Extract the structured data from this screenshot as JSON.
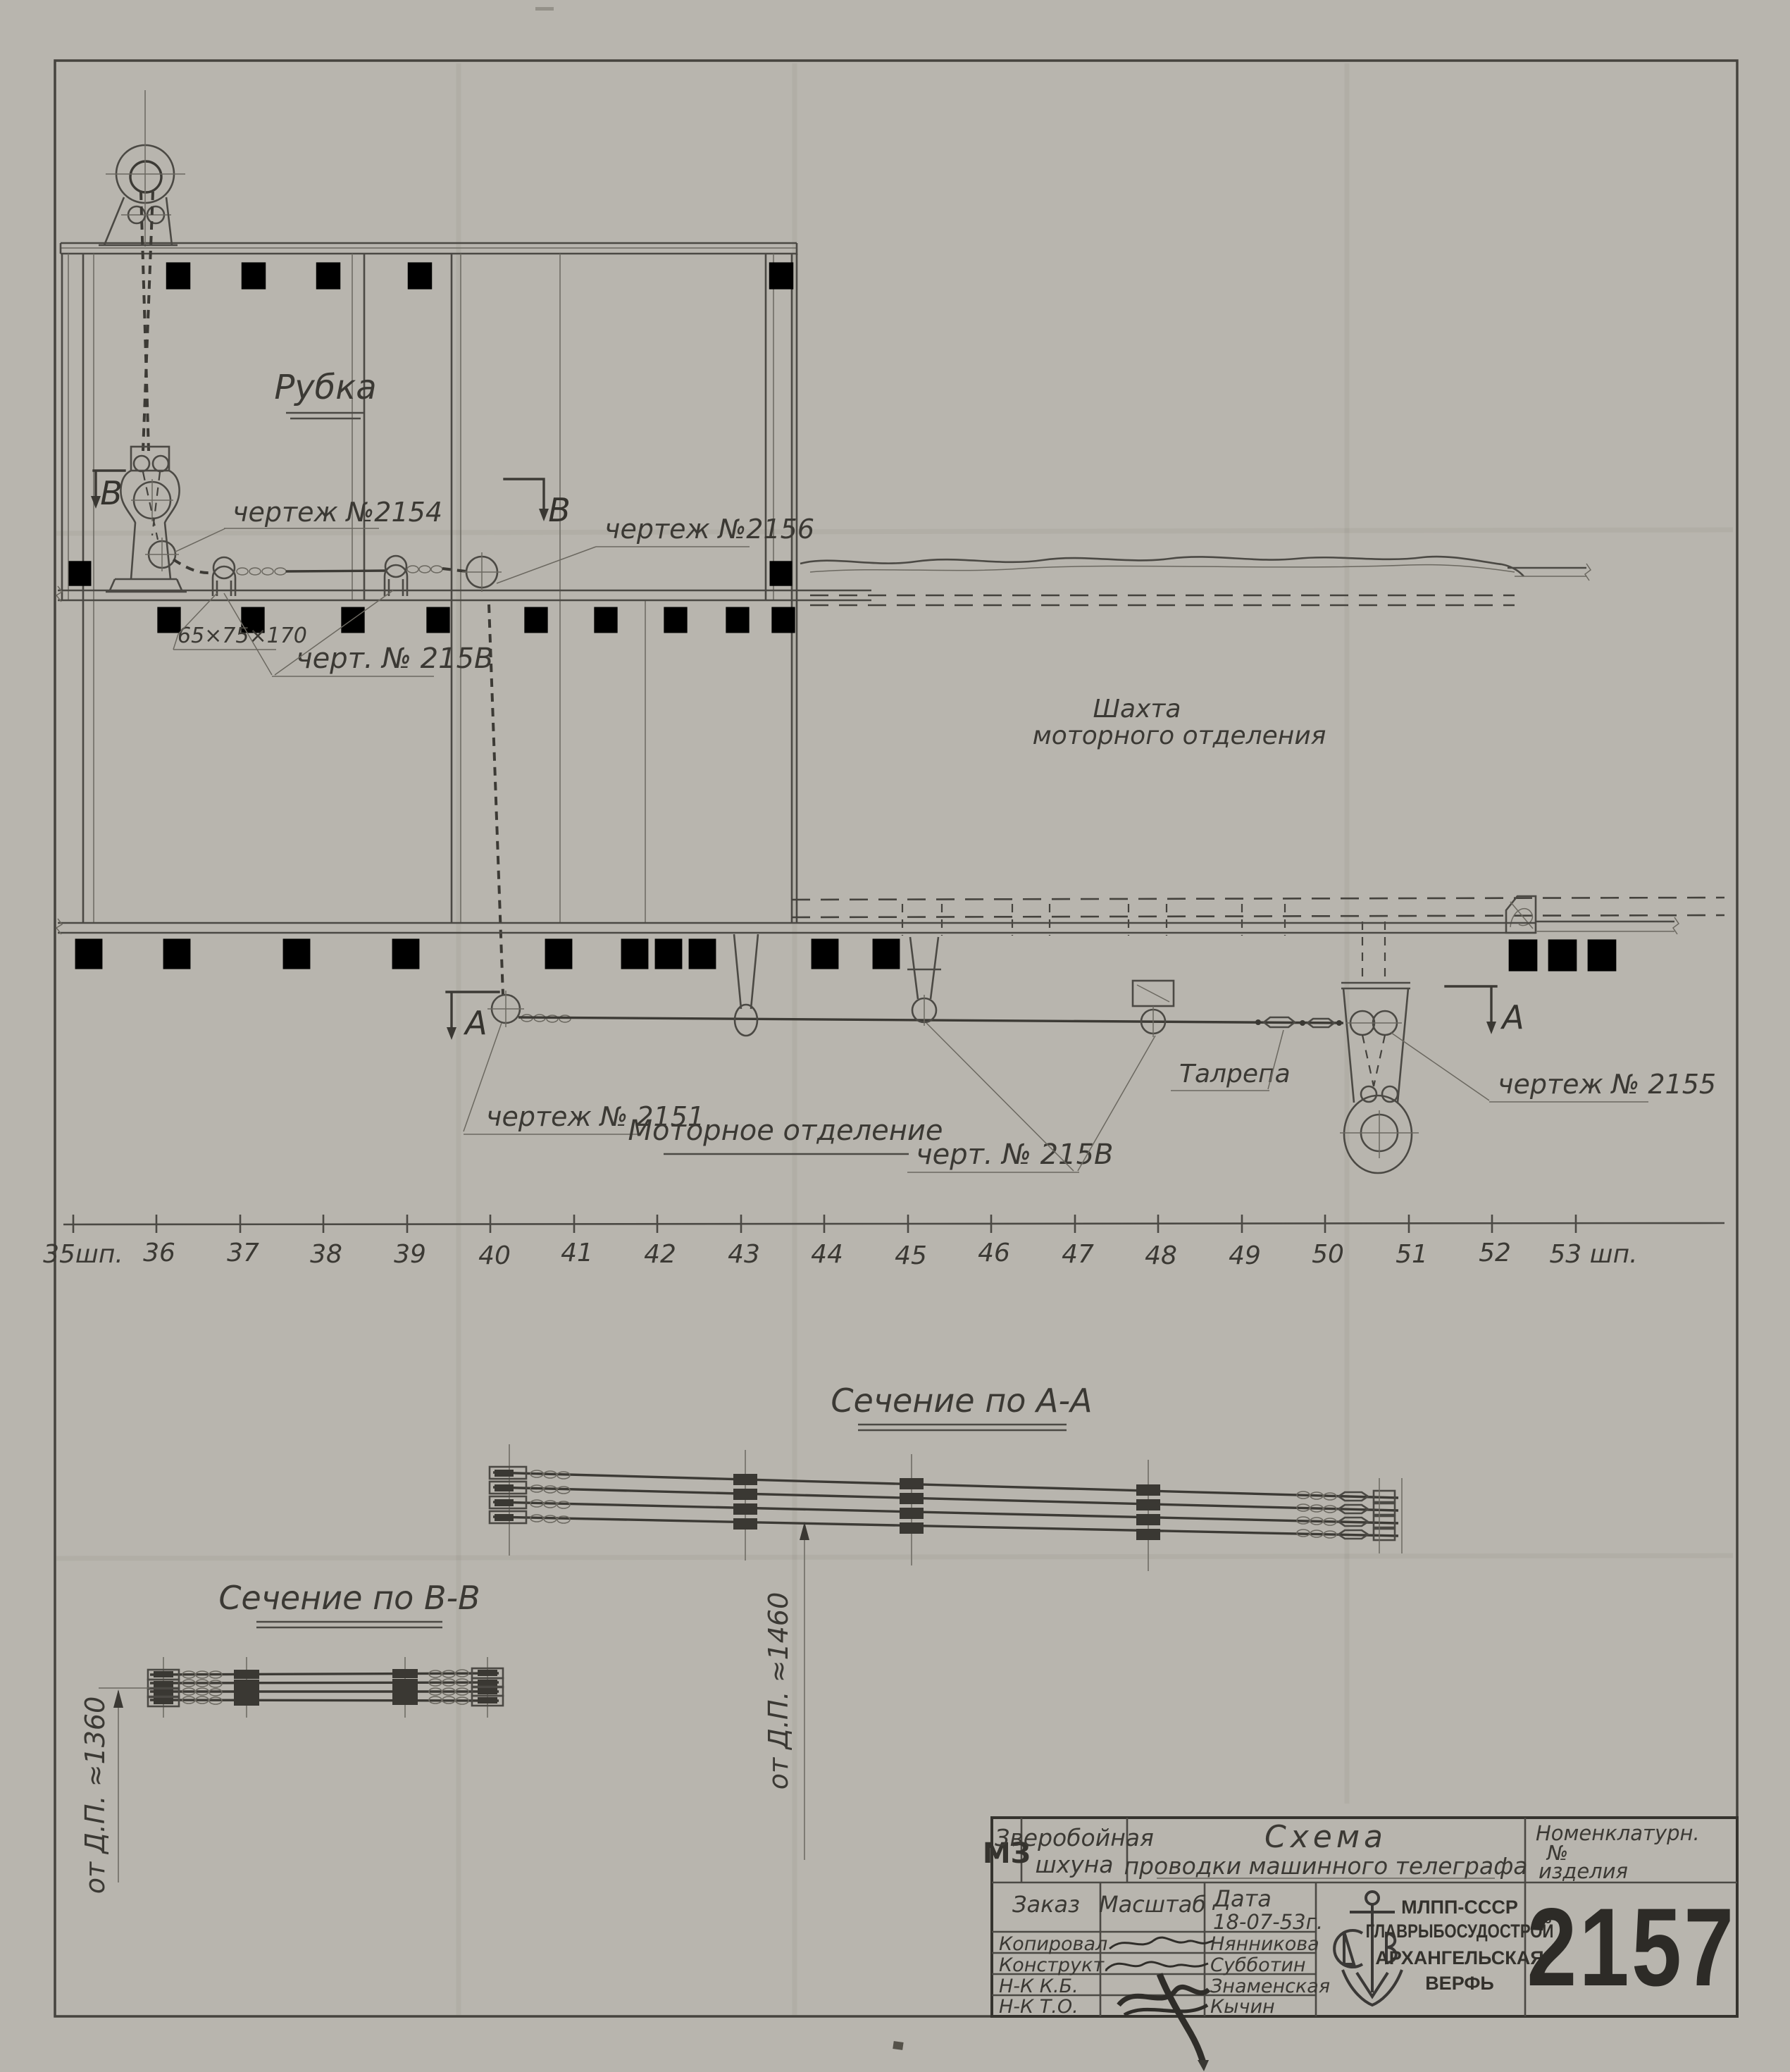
{
  "drawing": {
    "labels": {
      "rubka": "Рубка",
      "chertezh_2154": "чертеж №2154",
      "chertezh_2156": "чертеж №2156",
      "dim_65_75_170": "65×75×170",
      "chert_215v_upper": "черт. № 215В",
      "chertezh_2151": "чертеж № 2151",
      "chert_215v_lower": "черт. № 215В",
      "talrepa": "Талрепа",
      "chertezh_2155": "чертеж № 2155",
      "shahta_line1": "Шахта",
      "shahta_line2": "моторного отделения",
      "motornoe": "Моторное отделение",
      "section_b_mark_left": "В",
      "section_b_mark_right": "В",
      "section_a_mark_left": "А",
      "section_a_mark_right": "А",
      "section_aa_title": "Сечение по А-А",
      "section_bb_title": "Сечение по В-В",
      "dim_dp_1460": "от  Д.П. ≈1460",
      "dim_dp_1360": "от  Д.П. ≈1360"
    },
    "ruler": {
      "frames": [
        "35шп.",
        "36",
        "37",
        "38",
        "39",
        "40",
        "41",
        "42",
        "43",
        "44",
        "45",
        "46",
        "47",
        "48",
        "49",
        "50",
        "51",
        "52",
        "53 шп."
      ]
    },
    "title_block": {
      "code": "МЗ",
      "vessel_line1": "Зверобойная",
      "vessel_line2": "шхуна",
      "title_line1": "Схема",
      "title_line2": "проводки машинного телеграфа",
      "nomenclature_line1": "Номенклатурн.",
      "nomenclature_line2": "№",
      "nomenclature_line3": "изделия",
      "order_label": "Заказ",
      "scale_label": "Масштаб",
      "date_label": "Дата",
      "date_value": "18-07-53г.",
      "rows": [
        {
          "role": "Копировал",
          "name": "Нянникова"
        },
        {
          "role": "Конструкт.",
          "name": "Субботин"
        },
        {
          "role": "Н-К К.Б.",
          "name": "Знаменская"
        },
        {
          "role": "Н-К Т.О.",
          "name": "Кычин"
        }
      ],
      "org_line1": "МЛПП-СССР",
      "org_line2": "ГЛАВРЫБОСУДОСТРОЙ",
      "org_line3": "АРХАНГЕЛЬСКАЯ",
      "org_line4": "ВЕРФЬ",
      "doc_number": "2157"
    }
  }
}
